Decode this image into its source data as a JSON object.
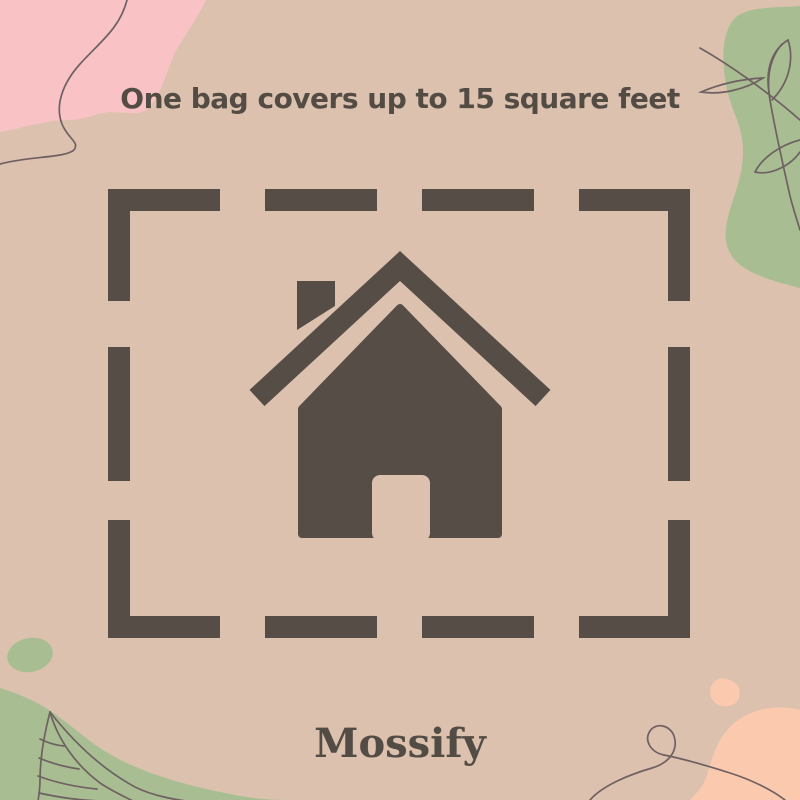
{
  "poster": {
    "headline": "One bag covers up to 15 square feet",
    "brand": "Mossify"
  },
  "graphic": {
    "center_icon": "house-icon",
    "frame": "dashed-rectangle-border",
    "decorations": [
      "pink-blob-top-left",
      "sage-blob-right",
      "green-blob-bottom-left",
      "green-dot-bottom-left",
      "peach-blob-bottom-right",
      "peach-dot-bottom-right",
      "squiggle-line-top-left",
      "branch-line-art-right",
      "leaf-line-art-bottom-left",
      "loop-squiggle-bottom-right"
    ]
  },
  "colors": {
    "bg": "#dcc1ae",
    "ink": "#564e46",
    "text": "#534c44",
    "pink": "#f9c3c6",
    "green": "#a8be92",
    "peach": "#fbc9ae",
    "line": "#6f6062"
  }
}
